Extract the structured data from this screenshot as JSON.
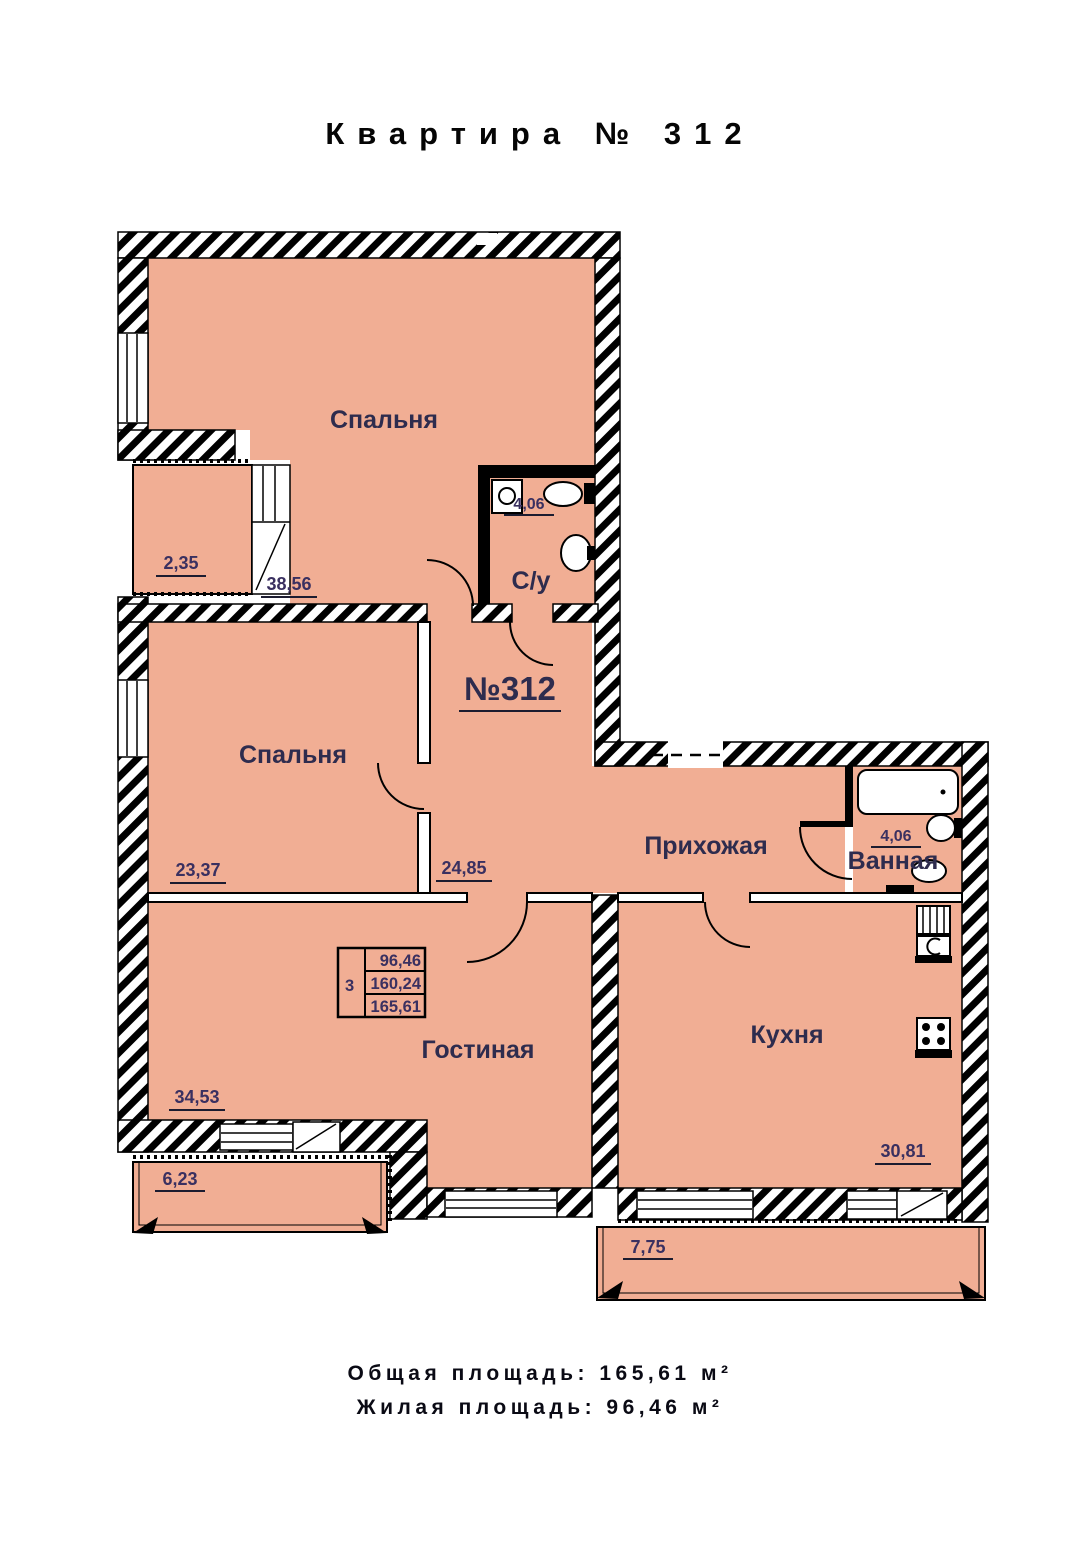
{
  "title": "Квартира № 312",
  "plan": {
    "apartment_label": "№312",
    "rooms": {
      "bedroom_top": {
        "name": "Спальня",
        "area": "38,56"
      },
      "bedroom_left": {
        "name": "Спальня",
        "area": "23,37"
      },
      "wc": {
        "name": "С/у",
        "area": "4,06"
      },
      "hallway": {
        "name": "Прихожая",
        "area": "24,85"
      },
      "bathroom": {
        "name": "Ванная",
        "area": "4,06"
      },
      "living_room": {
        "name": "Гостиная",
        "area": "34,53"
      },
      "kitchen": {
        "name": "Кухня",
        "area": "30,81"
      },
      "loggia": {
        "area": "2,35"
      },
      "balcony_left": {
        "area": "6,23"
      },
      "balcony_bottom": {
        "area": "7,75"
      }
    },
    "info_table": {
      "rooms_count": "3",
      "living_area": "96,46",
      "reduced_area": "160,24",
      "total_area": "165,61"
    }
  },
  "summary": {
    "total_line": "Общая площадь: 165,61 м²",
    "living_line": "Жилая площадь: 96,46 м²"
  },
  "colors": {
    "room_fill": "#f1ae94",
    "wall": "#000000",
    "label_text": "#2e2c4e",
    "number_text": "#3a3060"
  }
}
